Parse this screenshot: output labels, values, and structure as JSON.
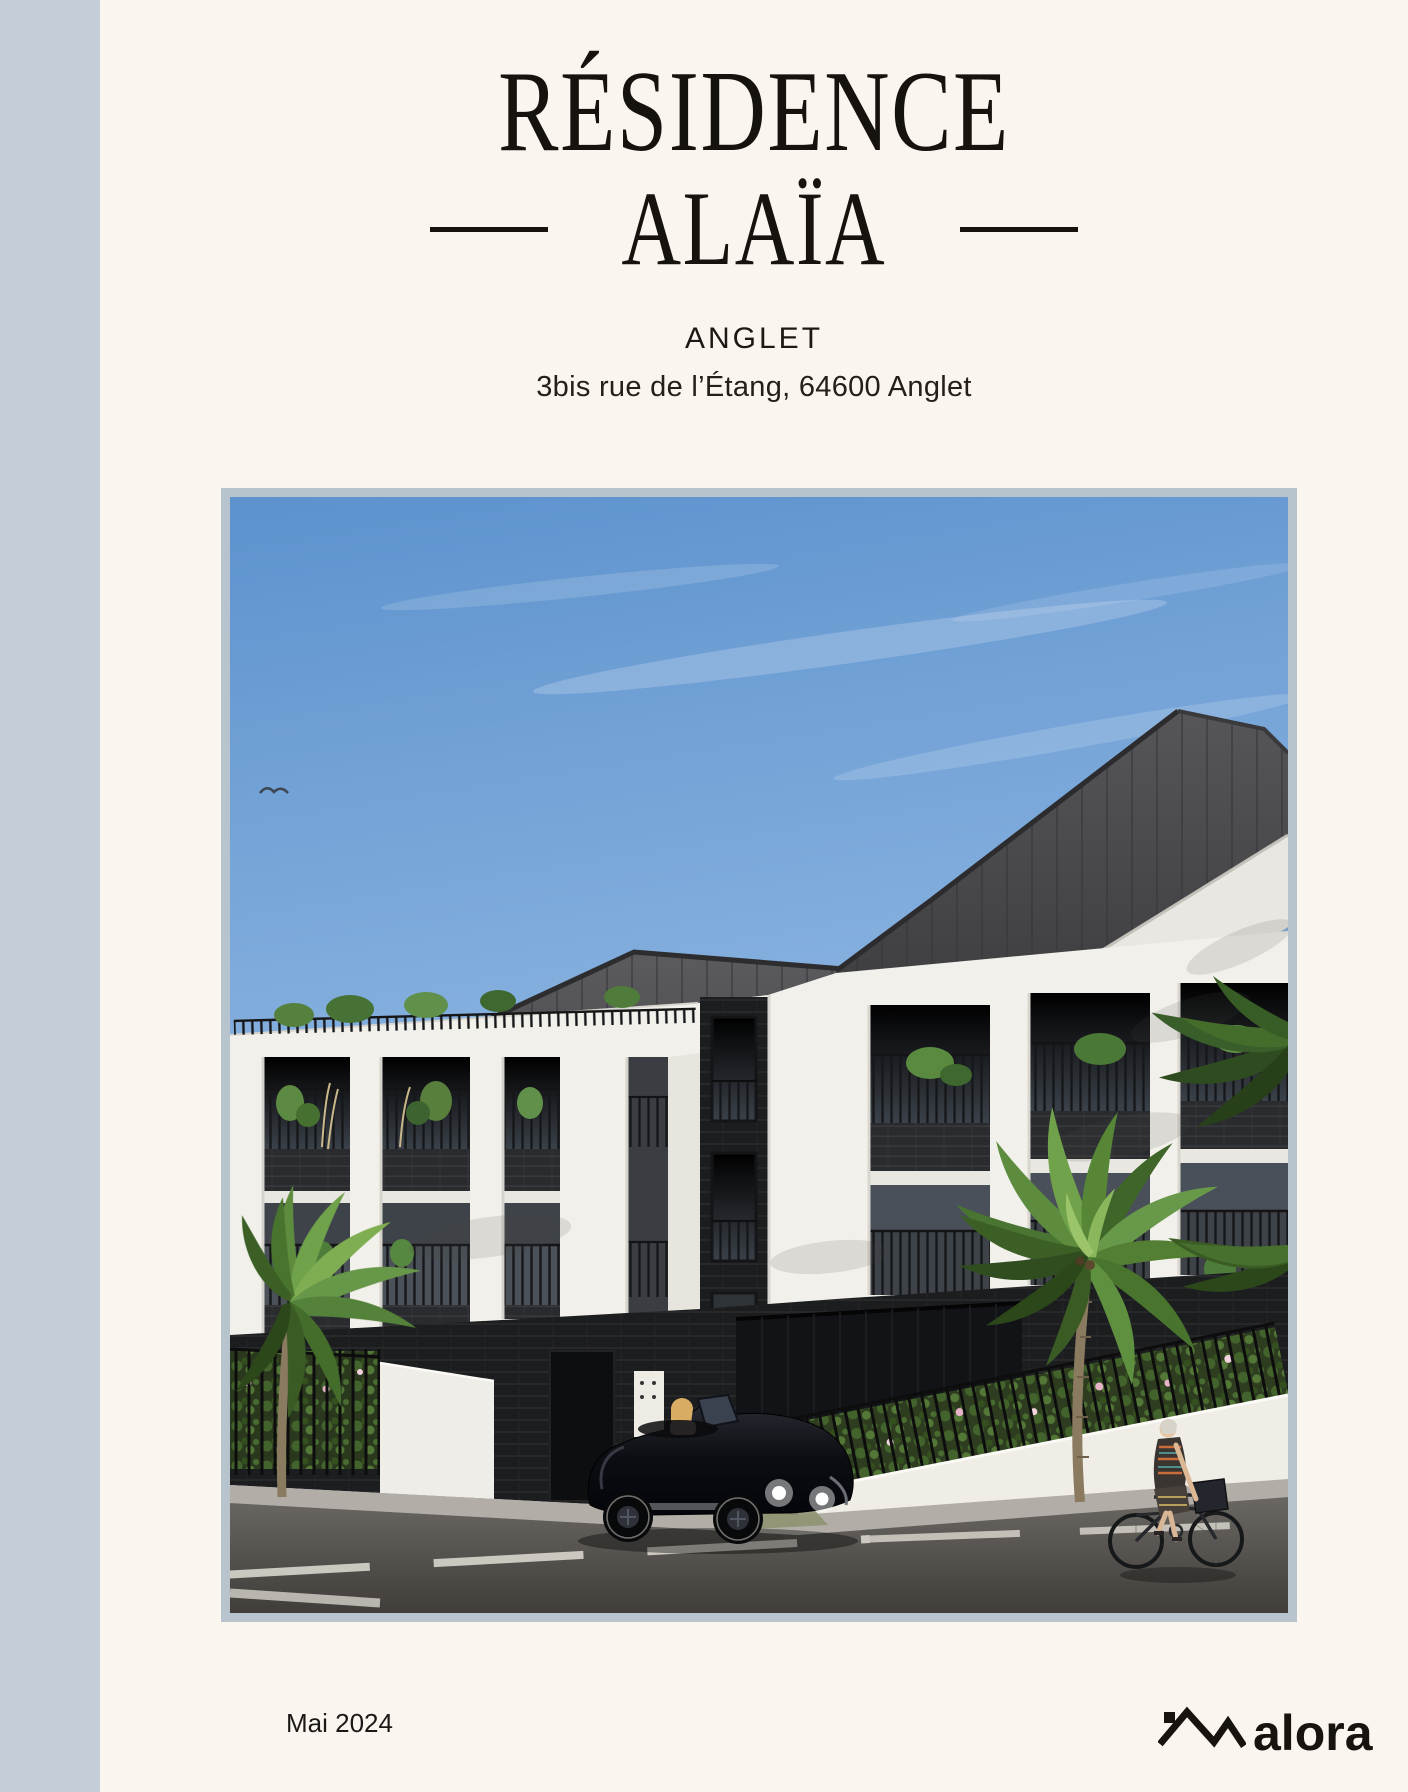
{
  "page": {
    "background": "#faf5ef",
    "stripe_color": "#c5cdd8",
    "ink_color": "#17130f"
  },
  "header": {
    "title_line1": "RÉSIDENCE",
    "title_line2": "ALAÏA",
    "city": "ANGLET",
    "address": "3bis rue de l’Étang, 64600 Anglet"
  },
  "hero": {
    "frame_color": "#b8c4cd",
    "alt": "Architectural rendering of the Alaïa residence street façade with palm trees, a black roadster and a cyclist"
  },
  "footer": {
    "date": "Mai 2024",
    "brand": "alora",
    "brand_icon": "roofline-icon"
  }
}
